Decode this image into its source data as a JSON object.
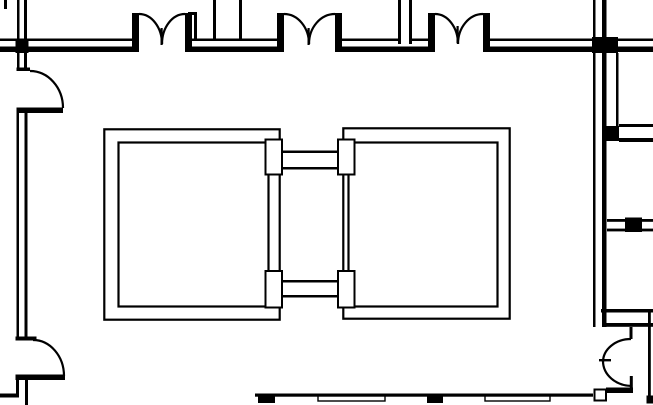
{
  "document": {
    "title": "Architectural floor plan - elevator core detail",
    "type": "CAD line drawing",
    "visible_text": ""
  },
  "canvas": {
    "width": 653,
    "height": 405,
    "background_color": "#ffffff",
    "line_color": "#000000"
  },
  "elements": {
    "top_wall": {
      "label": "Top corridor wall (double line) with three double-door openings"
    },
    "double_door_1": {
      "label": "Double door opening 1",
      "center_x": 162
    },
    "double_door_2": {
      "label": "Double door opening 2",
      "center_x": 309
    },
    "double_door_3": {
      "label": "Double door opening 3",
      "center_x": 458
    },
    "left_wall": {
      "label": "Left wall (double line) with two single swing doors"
    },
    "door_left_upper": {
      "label": "Swing door, left wall upper"
    },
    "door_left_lower": {
      "label": "Swing door, left wall lower"
    },
    "elevator_shaft_left": {
      "label": "Elevator shaft / room, left"
    },
    "elevator_shaft_right": {
      "label": "Elevator shaft / room, right"
    },
    "shaft_connector_top": {
      "label": "Separator wall between shafts, top"
    },
    "shaft_connector_bottom": {
      "label": "Separator wall between shafts, bottom"
    },
    "right_wall": {
      "label": "Right wall (double line) with two junctions and branch walls"
    },
    "door_bottom_right": {
      "label": "Double swing door, bottom right niche"
    },
    "bottom_wall": {
      "label": "Bottom wall with two window strips and two solid blocks"
    }
  }
}
